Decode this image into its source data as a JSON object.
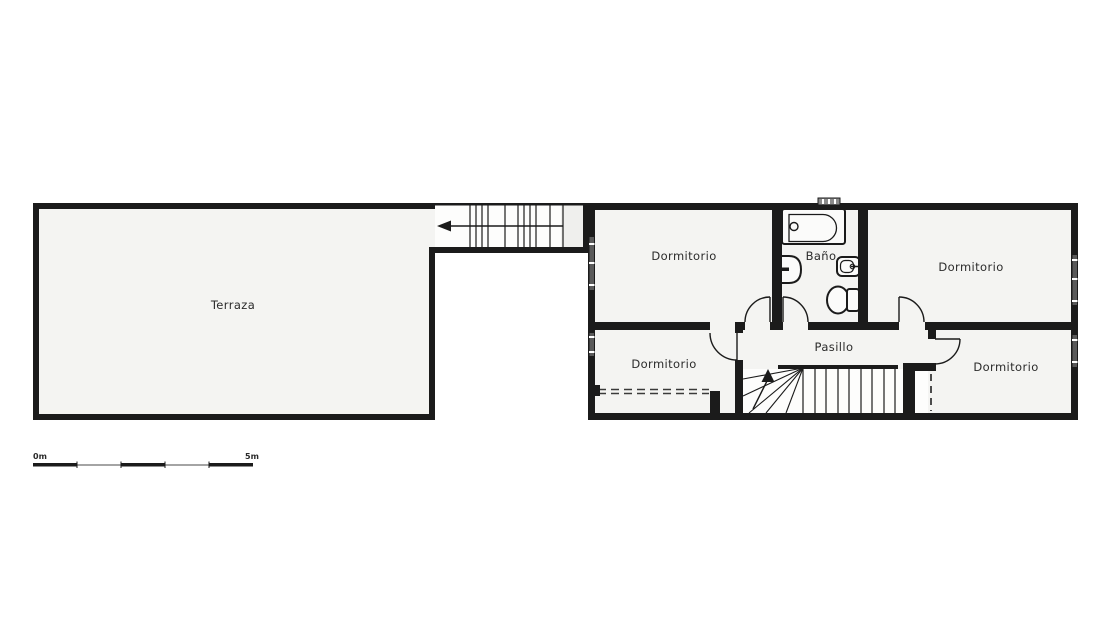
{
  "plan": {
    "type": "floor-plan",
    "rooms": {
      "terraza": {
        "label": "Terraza"
      },
      "dormitorio_nw": {
        "label": "Dormitorio"
      },
      "bano": {
        "label": "Baño"
      },
      "dormitorio_ne": {
        "label": "Dormitorio"
      },
      "dormitorio_sw": {
        "label": "Dormitorio"
      },
      "pasillo": {
        "label": "Pasillo"
      },
      "dormitorio_se": {
        "label": "Dormitorio"
      }
    },
    "scale_bar": {
      "start": "0m",
      "end": "5m"
    },
    "colors": {
      "wall": "#1b1b1b",
      "floor": "#f4f4f2",
      "stairwell": "#ffffff",
      "background": "#ffffff",
      "window": "#5a5a5a",
      "label_text": "#2b2b2b"
    }
  }
}
